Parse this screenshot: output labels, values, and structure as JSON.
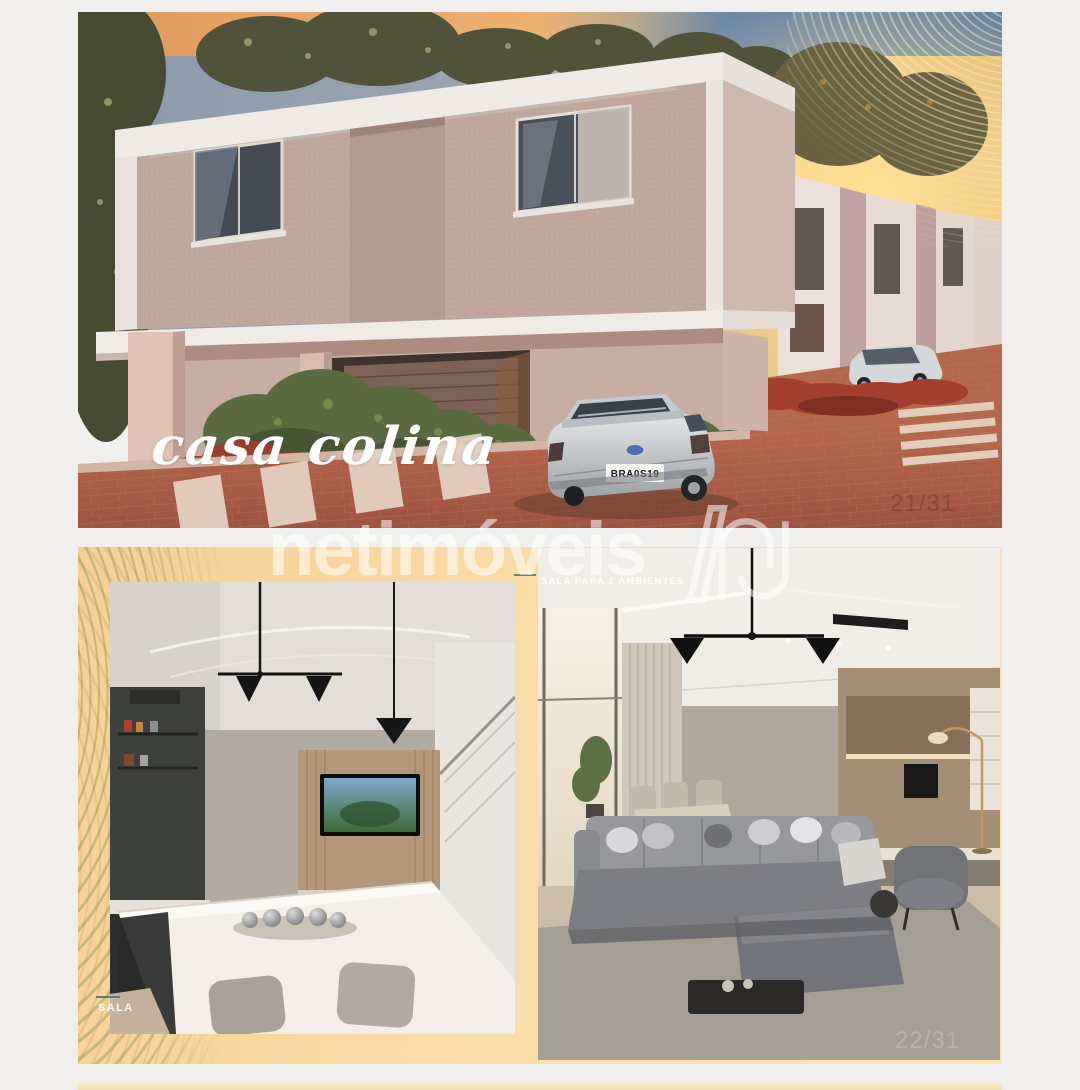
{
  "page": {
    "background_color": "#f0efee"
  },
  "gallery": {
    "brand_watermark": {
      "text": "netimóveis",
      "logo": "netimoveis-n-logo",
      "color": "#ffffff"
    },
    "photo_exterior": {
      "index_label": "21/31",
      "caption_script": "casa colina",
      "car_plate": "BRA0S19",
      "colors": {
        "sunset_band": "#e3a263",
        "sky_blue": "#7b90a8",
        "wall_stucco": "#c0a99c",
        "brick_paving": "#b06449"
      }
    },
    "photo_interiors": {
      "index_label": "22/31",
      "label_left_image": "SALA",
      "label_right_image": "SALA PARA 2 AMBIENTES",
      "accent_dash_color": "#3e7a6e",
      "background_color": "#f8d9a2",
      "contour_line_color": "#808e52"
    },
    "next_photo_strip_color": "#f4ebc4"
  }
}
